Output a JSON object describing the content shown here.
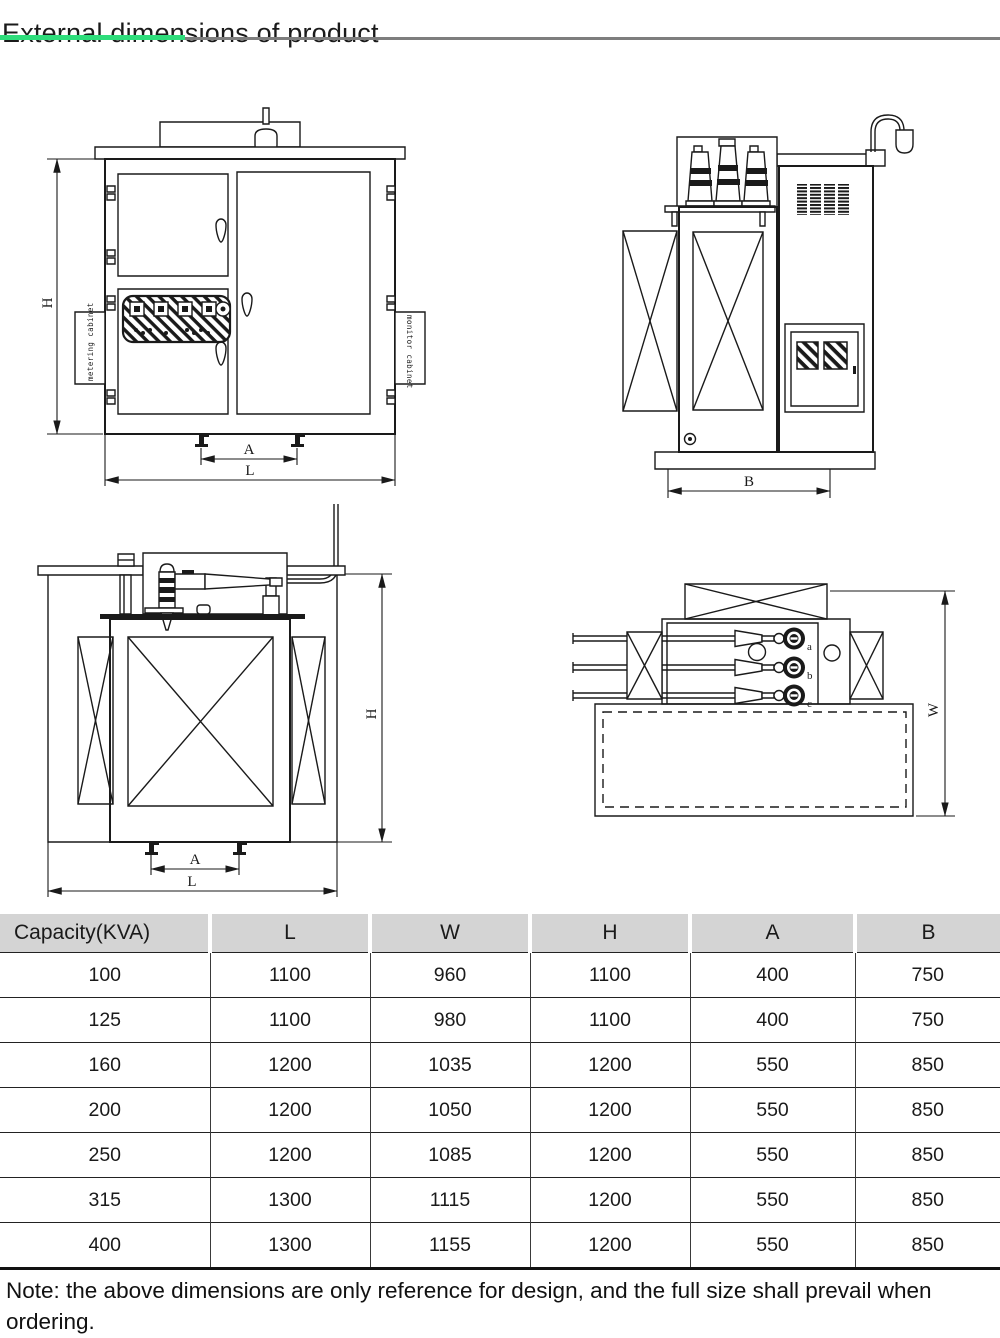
{
  "page": {
    "title": "External dimensions of product",
    "accent_green": "#2edd7b",
    "note": "Note: the above dimensions are only reference for design, and the full size shall prevail when ordering."
  },
  "drawings": {
    "front_view": {
      "dim_h": "H",
      "dim_a": "A",
      "dim_l": "L",
      "label_metering": "metering cabinet",
      "label_monitor": "monitor cabinet"
    },
    "side_view": {
      "dim_b": "B"
    },
    "hv_view": {
      "dim_h": "H",
      "dim_a": "A",
      "dim_l": "L"
    },
    "top_view": {
      "dim_w": "W",
      "phases": [
        "a",
        "b",
        "c"
      ]
    }
  },
  "table": {
    "headers": [
      "Capacity(KVA)",
      "L",
      "W",
      "H",
      "A",
      "B"
    ],
    "rows": [
      [
        "100",
        "1100",
        "960",
        "1100",
        "400",
        "750"
      ],
      [
        "125",
        "1100",
        "980",
        "1100",
        "400",
        "750"
      ],
      [
        "160",
        "1200",
        "1035",
        "1200",
        "550",
        "850"
      ],
      [
        "200",
        "1200",
        "1050",
        "1200",
        "550",
        "850"
      ],
      [
        "250",
        "1200",
        "1085",
        "1200",
        "550",
        "850"
      ],
      [
        "315",
        "1300",
        "1115",
        "1200",
        "550",
        "850"
      ],
      [
        "400",
        "1300",
        "1155",
        "1200",
        "550",
        "850"
      ]
    ]
  }
}
